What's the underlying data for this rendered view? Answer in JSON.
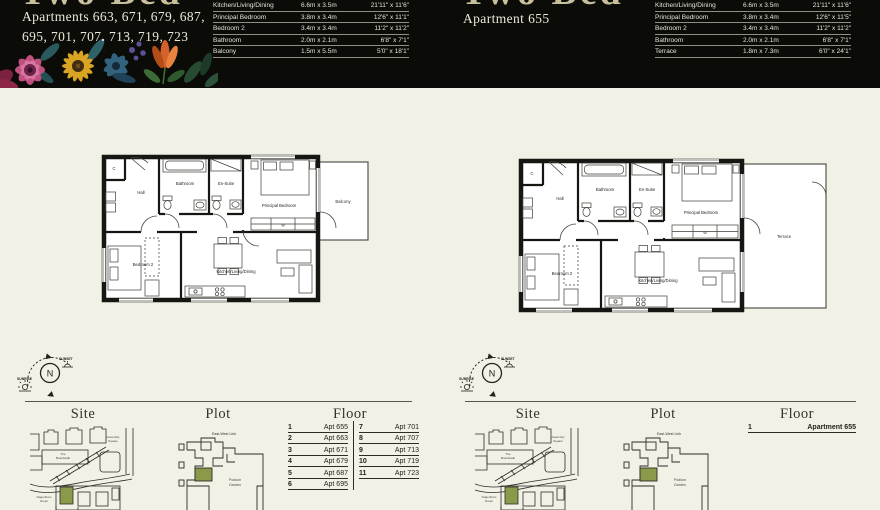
{
  "colors": {
    "header_bg": "#0b0b08",
    "page_bg": "#f2f1e5",
    "accent_green": "#8b9a4a",
    "title_gold": "#c9c19b",
    "line_dark": "#2c2c27"
  },
  "header": {
    "left": {
      "title": "Two Bed",
      "subtitle": "Apartments 663, 671, 679, 687, 695, 701, 707, 713, 719, 723",
      "dimensions": [
        {
          "room": "Kitchen/Living/Dining",
          "metric": "6.6m x 3.5m",
          "imperial": "21'11\" x 11'6\""
        },
        {
          "room": "Principal Bedroom",
          "metric": "3.8m x 3.4m",
          "imperial": "12'6\" x 11'1\""
        },
        {
          "room": "Bedroom 2",
          "metric": "3.4m x 3.4m",
          "imperial": "11'2\" x 11'2\""
        },
        {
          "room": "Bathroom",
          "metric": "2.0m x 2.1m",
          "imperial": "6'8\" x 7'1\""
        },
        {
          "room": "Balcony",
          "metric": "1.5m x 5.5m",
          "imperial": "5'0\" x 18'1\""
        }
      ]
    },
    "right": {
      "title": "Two Bed",
      "subtitle": "Apartment 655",
      "dimensions": [
        {
          "room": "Kitchen/Living/Dining",
          "metric": "6.6m x 3.5m",
          "imperial": "21'11\" x 11'6\""
        },
        {
          "room": "Principal Bedroom",
          "metric": "3.8m x 3.4m",
          "imperial": "12'6\" x 11'5\""
        },
        {
          "room": "Bedroom 2",
          "metric": "3.4m x 3.4m",
          "imperial": "11'2\" x 11'2\""
        },
        {
          "room": "Bathroom",
          "metric": "2.0m x 2.1m",
          "imperial": "6'8\" x 7'1\""
        },
        {
          "room": "Terrace",
          "metric": "1.8m x 7.3m",
          "imperial": "6'0\" x 24'1\""
        }
      ]
    }
  },
  "plans": {
    "left": {
      "hall": "Hall",
      "bathroom": "Bathroom",
      "ensuite": "En-Suite",
      "principal": "Principal Bedroom",
      "bedroom2": "Bedroom 2",
      "kitchen": "Kitchen/Living/Dining",
      "outdoor": "Balcony",
      "closet": "C",
      "wardrobe": "W"
    },
    "right": {
      "hall": "Hall",
      "bathroom": "Bathroom",
      "ensuite": "En-Suite",
      "principal": "Principal Bedroom",
      "bedroom2": "Bedroom 2",
      "kitchen": "Kitchen/Living/Dining",
      "outdoor": "Terrace",
      "closet": "C",
      "wardrobe": "W"
    }
  },
  "compass": {
    "north": "N",
    "sunrise": "SUNRISE",
    "sunset": "SUNSET"
  },
  "sections": {
    "site": "Site",
    "plot": "Plot",
    "floor": "Floor"
  },
  "site_map": {
    "assembly_1": "Assembly",
    "assembly_2": "Square",
    "boardwalk_1": "The",
    "boardwalk_2": "Boardwalk",
    "green_1": "Dagenham",
    "green_2": "Green"
  },
  "plot_map": {
    "east_west_link": "East-West Link",
    "podium_1": "Podium",
    "podium_2": "Garden"
  },
  "floor_lists": {
    "left": {
      "col1": [
        {
          "n": "1",
          "apt": "Apt 655"
        },
        {
          "n": "2",
          "apt": "Apt 663"
        },
        {
          "n": "3",
          "apt": "Apt 671"
        },
        {
          "n": "4",
          "apt": "Apt 679"
        },
        {
          "n": "5",
          "apt": "Apt 687"
        },
        {
          "n": "6",
          "apt": "Apt 695"
        }
      ],
      "col2": [
        {
          "n": "7",
          "apt": "Apt 701"
        },
        {
          "n": "8",
          "apt": "Apt 707"
        },
        {
          "n": "9",
          "apt": "Apt 713"
        },
        {
          "n": "10",
          "apt": "Apt 719"
        },
        {
          "n": "11",
          "apt": "Apt 723"
        }
      ]
    },
    "right": {
      "col1": [
        {
          "n": "1",
          "apt": "Apartment 655"
        }
      ]
    }
  }
}
